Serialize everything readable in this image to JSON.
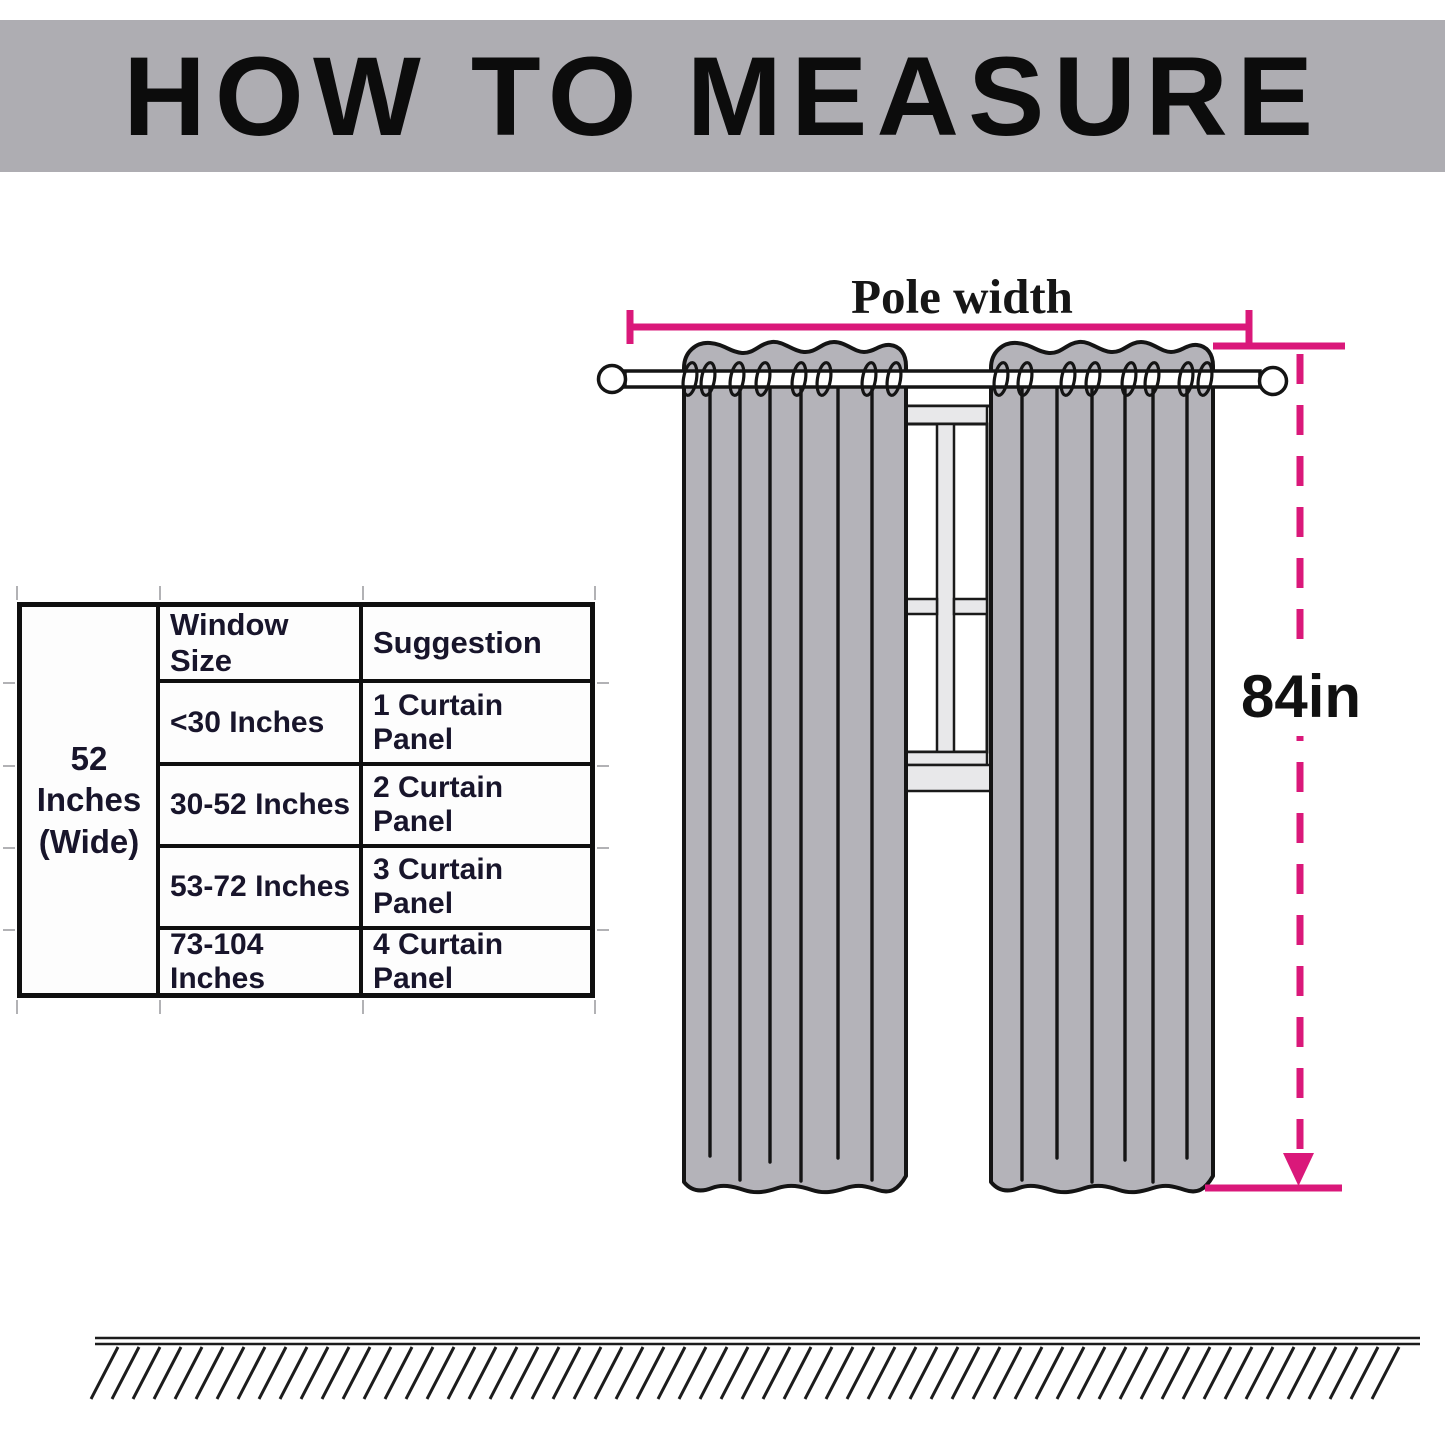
{
  "banner": {
    "title": "HOW TO MEASURE"
  },
  "diagram": {
    "pole_width_label": "Pole width",
    "height_label": "84in"
  },
  "table": {
    "side_header": {
      "line1": "52 Inches",
      "line2": "(Wide)"
    },
    "columns": [
      "Window Size",
      "Suggestion"
    ],
    "rows": [
      {
        "window_size": "<30 Inches",
        "suggestion": "1 Curtain Panel"
      },
      {
        "window_size": "30-52 Inches",
        "suggestion": "2 Curtain Panel"
      },
      {
        "window_size": "53-72 Inches",
        "suggestion": "3 Curtain Panel"
      },
      {
        "window_size": "73-104 Inches",
        "suggestion": "4 Curtain Panel"
      }
    ]
  },
  "colors": {
    "accent_pink": "#da187a",
    "curtain_gray": "#b4b3b9",
    "banner_gray": "#aeadb2",
    "window_pane_gray": "#e8e8ea"
  }
}
